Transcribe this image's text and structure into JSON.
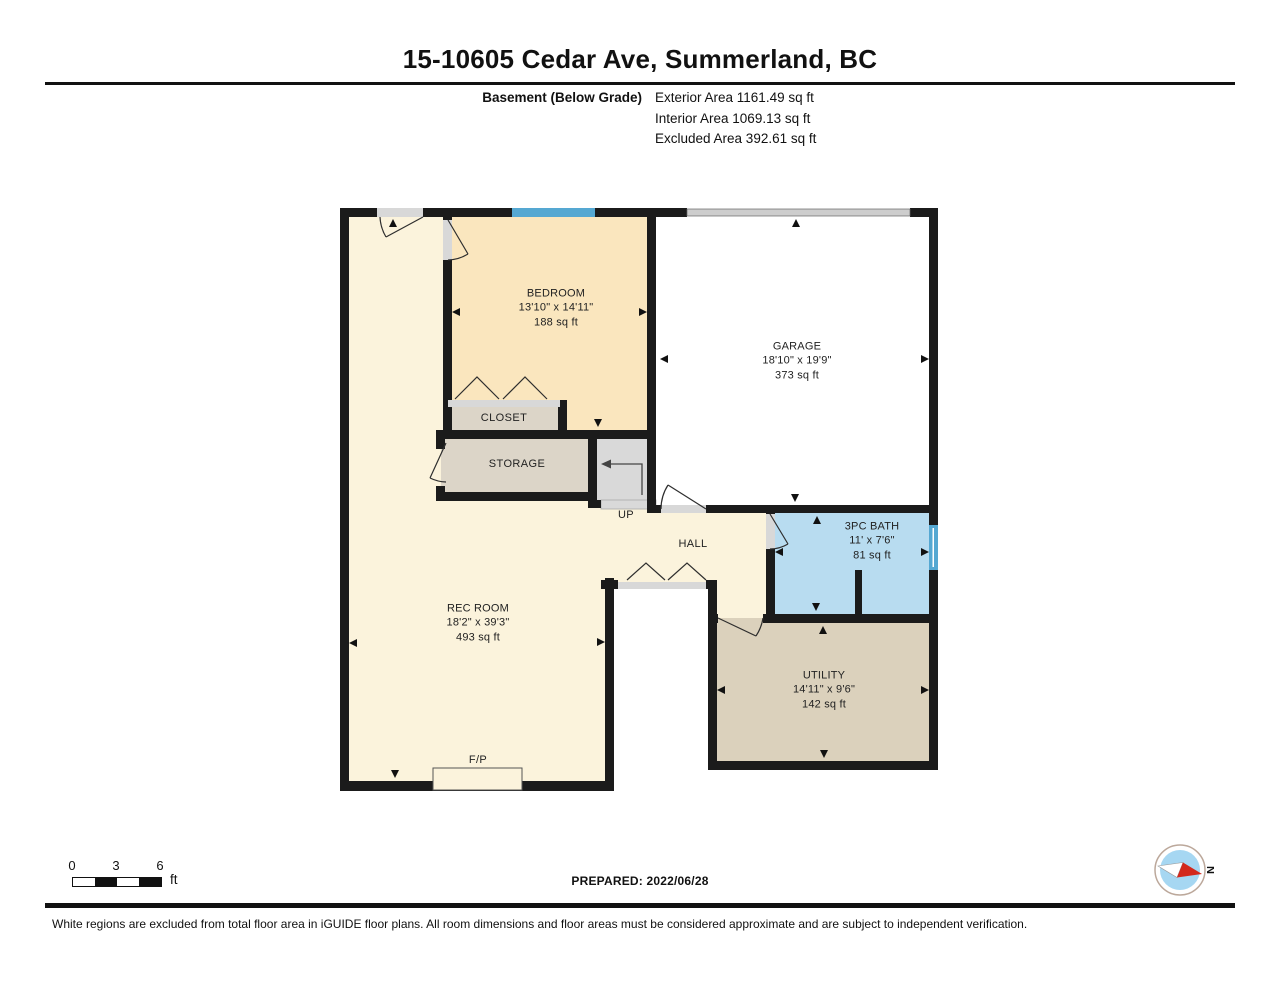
{
  "page_title": "15-10605 Cedar Ave, Summerland, BC",
  "summary": {
    "floor_label": "Basement (Below Grade)",
    "area_lines": [
      "Exterior Area 1161.49 sq ft",
      "Interior Area 1069.13 sq ft",
      "Excluded Area 392.61 sq ft"
    ]
  },
  "rooms": {
    "bedroom": {
      "name": "BEDROOM",
      "dims": "13'10\" x 14'11\"",
      "area": "188 sq ft"
    },
    "garage": {
      "name": "GARAGE",
      "dims": "18'10\" x 19'9\"",
      "area": "373 sq ft"
    },
    "bath": {
      "name": "3PC BATH",
      "dims": "11' x 7'6\"",
      "area": "81 sq ft"
    },
    "rec_room": {
      "name": "REC ROOM",
      "dims": "18'2\" x 39'3\"",
      "area": "493 sq ft"
    },
    "utility": {
      "name": "UTILITY",
      "dims": "14'11\" x 9'6\"",
      "area": "142 sq ft"
    },
    "closet": {
      "name": "CLOSET"
    },
    "storage": {
      "name": "STORAGE"
    },
    "hall": {
      "name": "HALL"
    }
  },
  "annotations": {
    "stairs_direction": "UP",
    "fireplace": "F/P"
  },
  "scale_bar": {
    "ticks": [
      "0",
      "3",
      "6"
    ],
    "unit": "ft"
  },
  "footer": {
    "prepared": "PREPARED: 2022/06/28",
    "disclaimer": "White regions are excluded from total floor area in iGUIDE floor plans. All room dimensions and floor areas must be considered approximate and are subject to independent verification."
  },
  "compass": {
    "north_label": "N"
  },
  "colors": {
    "wall": "#1b1b1b",
    "arrow_black": "#111111",
    "rec_room_fill": "#FBF3DC",
    "bedroom_fill": "#FAE6BE",
    "garage_fill": "#FFFFFF",
    "bath_fill": "#B8DCF0",
    "utility_fill": "#DBD1BC",
    "closet_fill": "#DCD5C8",
    "storage_fill": "#DCD5C8",
    "stairs_fill": "#D9D9D9",
    "window_blue": "#55A8D2",
    "garage_door_gray": "#CDCDCD",
    "sill_gray": "#D8D8D8",
    "compass_blue": "#A6D7F2",
    "compass_red": "#D3291C",
    "compass_ring": "#BCA89B"
  }
}
